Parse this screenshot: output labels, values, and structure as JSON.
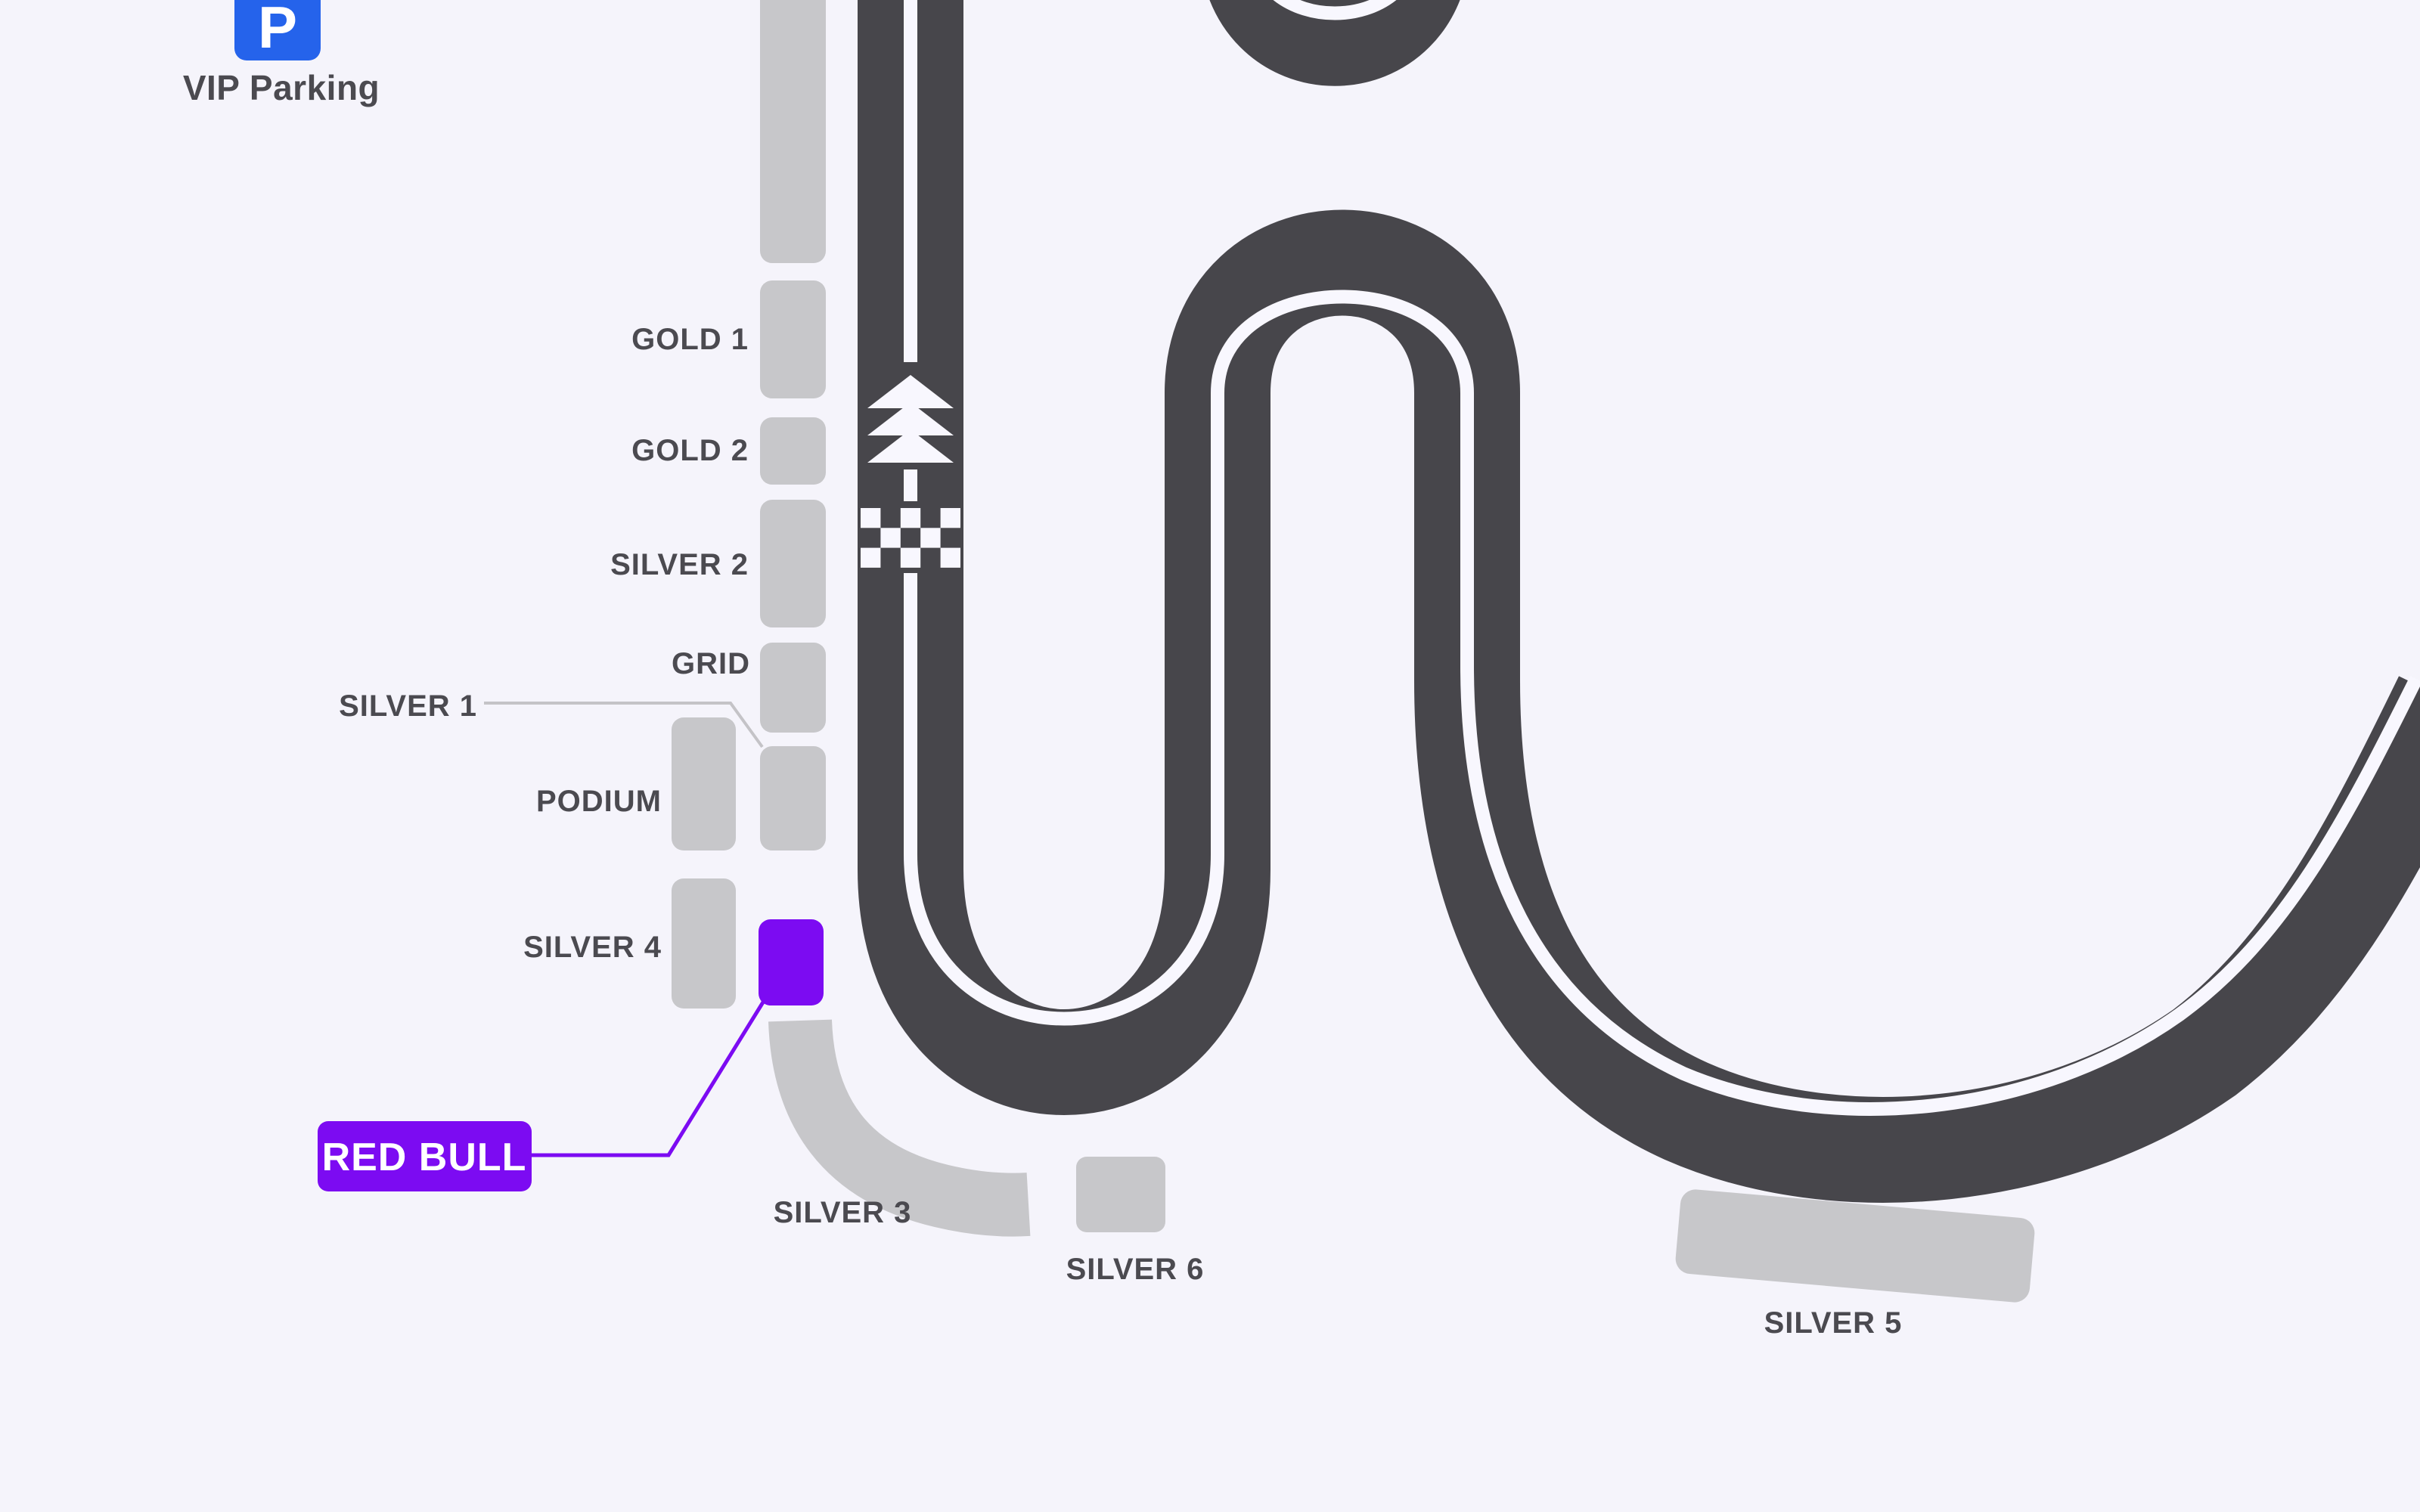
{
  "title": "Circuit grandstand map",
  "colors": {
    "bg": "#F5F4FB",
    "track": "#47464B",
    "line": "#F8F7FE",
    "stand": "#C7C7CA",
    "label": "#4B4A50",
    "purple": "#7C0BF2",
    "blue": "#2563EB",
    "leader": "#C4C3C7"
  },
  "parking": {
    "icon_letter": "P",
    "label": "VIP Parking"
  },
  "stands": {
    "gold1": "GOLD 1",
    "gold2": "GOLD 2",
    "silver2": "SILVER 2",
    "grid": "GRID",
    "silver1": "SILVER 1",
    "podium": "PODIUM",
    "silver4": "SILVER 4",
    "silver3": "SILVER 3",
    "silver6": "SILVER 6",
    "silver5": "SILVER 5"
  },
  "highlight": {
    "team": "RED BULL"
  },
  "track_markings": {
    "start_finish": "checkered-flag",
    "direction": "up-arrows"
  }
}
